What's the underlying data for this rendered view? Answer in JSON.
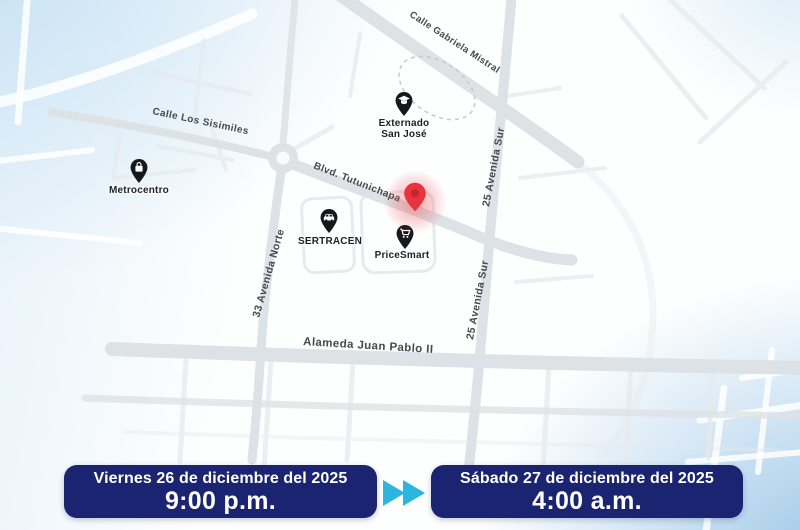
{
  "map": {
    "street_labels": {
      "gabriela_mistral": "Calle Gabriela Mistral",
      "los_sisimiles": "Calle Los Sisimiles",
      "tutunichapa": "Blvd. Tutunichapa",
      "avenida_33_norte": "33 Avenida Norte",
      "avenida_25_sur_upper": "25 Avenida Sur",
      "avenida_25_sur_lower": "25 Avenida Sur",
      "alameda_juan_pablo": "Alameda Juan Pablo II"
    },
    "pois": [
      {
        "id": "metrocentro",
        "label": "Metrocentro",
        "icon": "shopping-bag-icon"
      },
      {
        "id": "externado-san-jose",
        "label": "Externado\nSan José",
        "icon": "graduation-cap-icon"
      },
      {
        "id": "sertracen",
        "label": "SERTRACEN",
        "icon": "car-icon"
      },
      {
        "id": "pricesmart",
        "label": "PriceSmart",
        "icon": "shopping-cart-icon"
      }
    ],
    "closure_marker": {
      "icon": "red-pin-icon"
    }
  },
  "schedule": {
    "start": {
      "date": "Viernes 26 de diciembre del 2025",
      "time": "9:00 p.m."
    },
    "end": {
      "date": "Sábado 27 de diciembre del 2025",
      "time": "4:00 a.m."
    },
    "transition_icon": "fast-forward-icon"
  },
  "colors": {
    "banner_background": "#1a2470",
    "banner_text": "#ffffff",
    "fast_forward_cyan": "#2bb6e0",
    "road_gray": "#dde2e6",
    "poi_pin_black": "#17181b",
    "closure_pin_red": "#e8353d",
    "map_label_gray": "#46494d",
    "background_tint_blue": "#cfe5f4"
  }
}
